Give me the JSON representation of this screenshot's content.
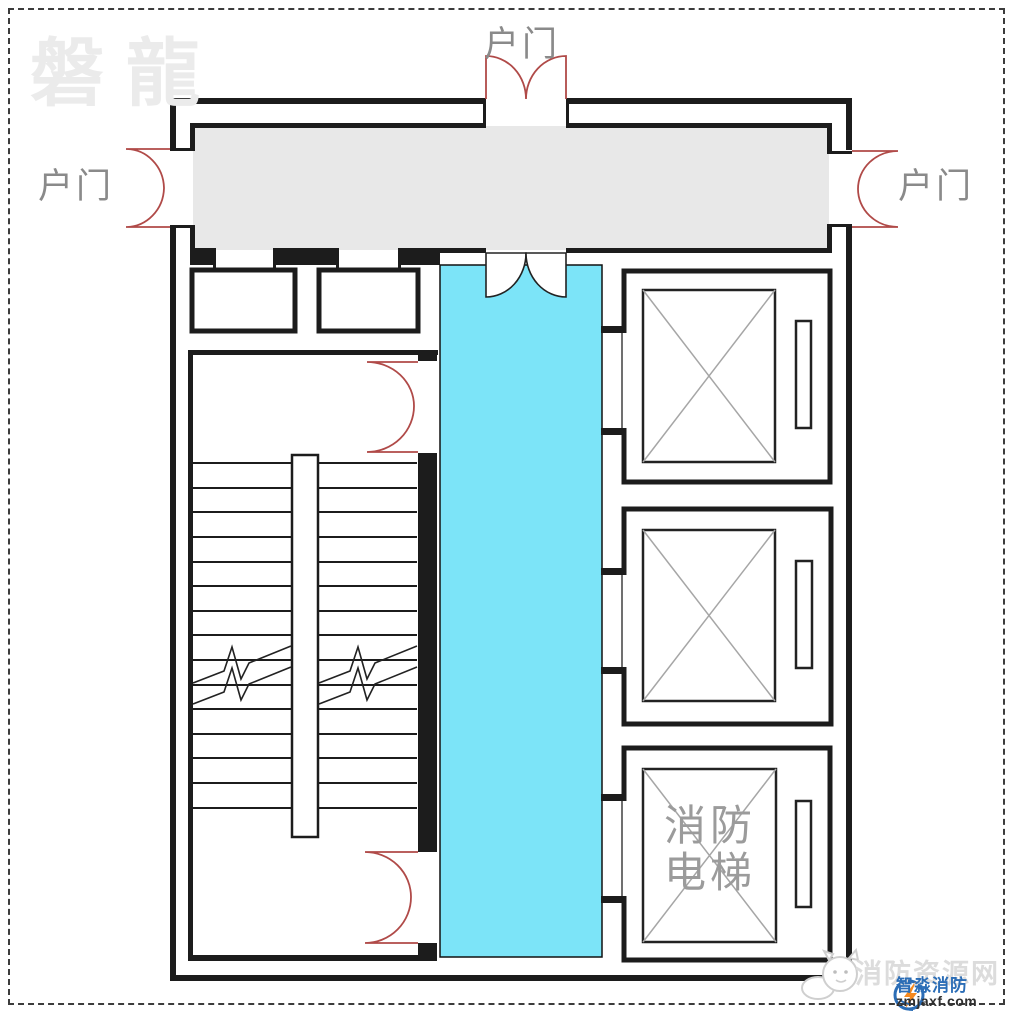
{
  "watermarks": {
    "top_left": "磐龍",
    "bottom_right": "消防资源网"
  },
  "door_labels": {
    "top": "户门",
    "left": "户门",
    "right": "户门"
  },
  "fire_elevator": {
    "line1": "消防",
    "line2": "电梯"
  },
  "footer_logo": {
    "brand": "智淼消防",
    "site": "zmjaxf.com"
  },
  "colors": {
    "wall": "#1c1c1c",
    "corridor_fill": "#e8e8e8",
    "highlight_corridor": "#7ce4f8",
    "door_swing": "#b04a48",
    "label_text": "#8a8a8a",
    "watermark_text": "#ebebeb",
    "footer_watermark": "#dcdcdc",
    "elevator_x": "#a6a6a6",
    "brand_blue": "#2b6db6",
    "brand_orange": "#f6891e",
    "fire_label": "#9b9b9b"
  }
}
